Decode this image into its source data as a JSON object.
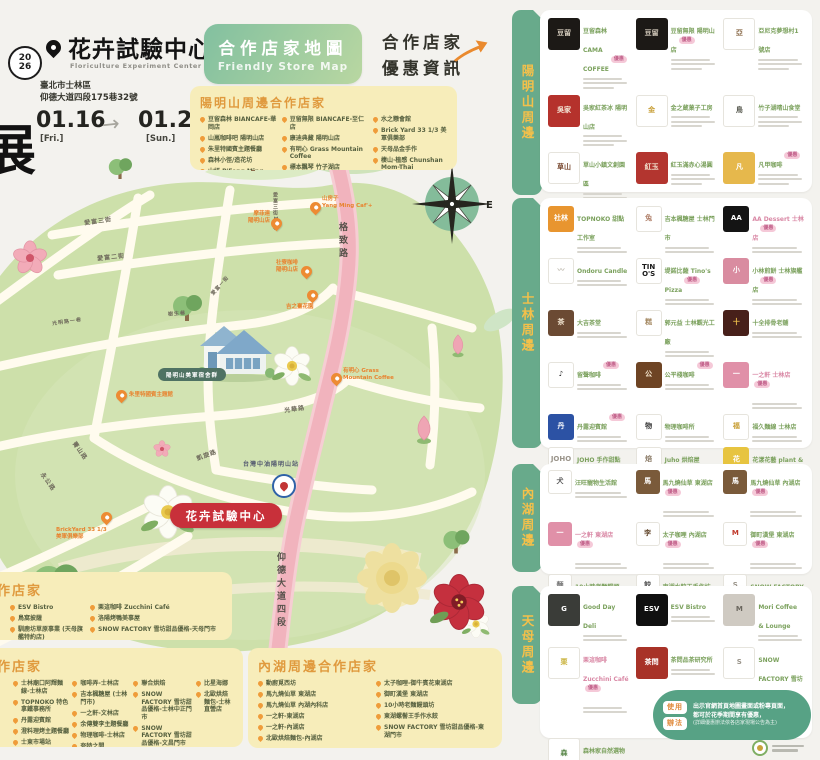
{
  "header": {
    "year_line1": "20",
    "year_line2": "26",
    "side_glyph": "展",
    "title": "花卉試驗中心",
    "subtitle": "Floriculture Experiment Center",
    "address_line1": "臺北市士林區",
    "address_line2": "仰德大道四段175巷32號",
    "date_start": "01.16",
    "date_start_day": "[Fri.]",
    "date_end": "01.25",
    "date_end_day": "[Sun.]",
    "arrow": "→"
  },
  "banner": {
    "title": "合作店家地圖",
    "subtitle": "Friendly Store Map"
  },
  "promo": {
    "line1": "合作店家",
    "line2": "優惠資訊"
  },
  "ym_box": {
    "title": "陽明山周邊合作店家",
    "cols": [
      [
        "豆留森林 BIANCAFE-華岡店",
        "山嵐咖啡吧 陽明山店",
        "朱里特國賓主題餐廳",
        "森林小徑/造花坊",
        "山妍 P'Feng Ming Caf'+"
      ],
      [
        "豆留無限 BIANCAFE-至仁店",
        "康迪典藏 陽明山店",
        "有明心 Grass Mountain Coffee",
        "標本飄琴 竹子湖店",
        "天溪梅仙人掌園"
      ],
      [
        "水之戀會館",
        "Brick Yard 33 1/3 美軍俱樂部",
        "天母品金手作",
        "棲山·植感 Chunshan Mom-Thai Glamping"
      ]
    ]
  },
  "map": {
    "compass_n": "N",
    "compass_e": "E",
    "center_badge": "花卉試驗中心",
    "house_label": "陽明山美軍宿舍群",
    "gas_label": "台灣中油陽明山站",
    "labels": {
      "aifu3": "愛富三街",
      "aifu2": "愛富二街",
      "aifu1": "愛富一街",
      "lane12": "愛富三街12巷",
      "gezhi": "格致路",
      "yangde": "仰德大道四段",
      "guanghua": "光華路",
      "kaixuan": "凱旋路",
      "jingshan": "菁山路",
      "yonggong": "永公路",
      "shusheng": "樹生巷",
      "zuoan": "光明路一巷"
    },
    "pins": [
      {
        "l1": "山房子",
        "l2": "Yang Ming Caf'+"
      },
      {
        "l1": "摩菲連",
        "l2": "陽明山店"
      },
      {
        "l1": "社寮咖啡",
        "l2": "陽明山店"
      },
      {
        "l1": "吉之臺花園",
        "l2": ""
      },
      {
        "l1": "有明心 Grass",
        "l2": "Mountain Coffee"
      },
      {
        "l1": "朱里特國賓主題館",
        "l2": ""
      },
      {
        "l1": "BrickYard 33 1/3",
        "l2": "美軍俱樂部"
      }
    ]
  },
  "bottom": {
    "tianmu": {
      "title": "天母周邊合作店家",
      "cols": [
        [
          "ESV Bistro",
          "鳥窩披薩",
          "馴鹿坊草原事業 (天母旗艦特約店)"
        ],
        [
          "栗這咖啡 Zucchini Café",
          "洛陽烤鴨美事屋",
          "SNOW FACTORY 雪坊甜品優格-天母門市"
        ]
      ]
    },
    "shilin": {
      "title": "士林周邊合作店家",
      "cols": [
        [
          "士林廟口阿輝麵線-士林店",
          "TOPNOKO 特色拿鐵事務所",
          "丹露迎賓館",
          "澄料理烤主題餐廳",
          "士東市場站",
          "記得擁抱純手工皂花店"
        ],
        [
          "咖啡弄-士林店",
          "吉本楓糖屋 (士林門市)",
          "一之軒-文林店",
          "余傳雙李主題餐廳",
          "物理咖啡-士林店",
          "夸特之間"
        ],
        [
          "聯合烘焙",
          "SNOW FACTORY 雪坊甜品優格-士林中正門市",
          "SNOW FACTORY 雪坊甜品優格-文昌門市",
          "Juho烘焙屋",
          "花漾花藝人/plant & studio"
        ],
        [
          "比星海娜",
          "北歐烘焙麵包-士林直營店"
        ]
      ]
    },
    "neihu": {
      "title": "內湖周邊合作店家",
      "cols": [
        [
          "動廚覓西坊",
          "馬九燒仙草 東湖店",
          "馬九燒仙草 內湖內科店",
          "一之軒-東湖店",
          "一之軒-內湖店",
          "北歐烘焙麵包-內湖店"
        ],
        [
          "太子咖哩-御牛賓花東湖店",
          "御町漢堡 東湖店",
          "10小時老麵饅頭坊",
          "東湖螺髻王手作水餃",
          "SNOW FACTORY 雪坊甜品優格-東湖門市"
        ]
      ]
    }
  },
  "right_panel": {
    "tabs": [
      "陽明山周邊",
      "士林周邊",
      "內湖周邊",
      "天母周邊"
    ],
    "sections": [
      [
        {
          "logo_bg": "#1c1916",
          "logo_fg": "#d8cfc0",
          "logo_text": "豆留",
          "name": "豆留森林 CAMA COFFEE",
          "badge": "優惠"
        },
        {
          "logo_bg": "#1c1916",
          "logo_fg": "#d8cfc0",
          "logo_text": "豆留",
          "name": "豆留無限 陽明山店",
          "badge": "優惠"
        },
        {
          "logo_bg": "#ffffff",
          "logo_fg": "#8a6b4a",
          "logo_text": "亞",
          "name": "亞尼克夢想村1號店"
        },
        {
          "logo_bg": "#b5322c",
          "logo_fg": "#f5e9d8",
          "logo_text": "吳家",
          "name": "吳家紅茶冰 陽明山店"
        },
        {
          "logo_bg": "#ffffff",
          "logo_fg": "#c9a13b",
          "logo_text": "金",
          "name": "金之蔵菓子工房"
        },
        {
          "logo_bg": "#ffffff",
          "logo_fg": "#56584e",
          "logo_text": "鳥",
          "name": "竹子湖晴山食堂"
        },
        {
          "logo_bg": "#ffffff",
          "logo_fg": "#7a4b32",
          "logo_text": "草山",
          "name": "草山小鎮文創園區"
        },
        {
          "logo_bg": "#b3352f",
          "logo_fg": "#f2e4d0",
          "logo_text": "紅玉",
          "name": "紅玉滿赤心湯圓"
        },
        {
          "logo_bg": "#e6b84c",
          "logo_fg": "#ffffff",
          "logo_text": "凡",
          "name": "凡甲咖啡",
          "badge": "優惠"
        },
        {
          "logo_bg": "#ffffff",
          "logo_fg": "#2e2b28",
          "logo_text": "白房子",
          "name": "白房子 Yang Ming Caf'+"
        },
        {
          "logo_bg": "#ffffff",
          "logo_fg": "#6b7d56",
          "logo_text": "植",
          "name": "棲山植感 Chunshan Mom-Thai Glamping"
        }
      ],
      [
        {
          "logo_bg": "#e8952f",
          "logo_fg": "#ffffff",
          "logo_text": "社林",
          "name": "TOPNOKO 甜點工作室"
        },
        {
          "logo_bg": "#ffffff",
          "logo_fg": "#b0806a",
          "logo_text": "兔",
          "name": "吉本楓糖屋 士林門市"
        },
        {
          "logo_bg": "#141414",
          "logo_fg": "#ffffff",
          "logo_text": "AA",
          "name": "AA Dessert 士林店",
          "badge": "優惠",
          "name_color": "#d988a5"
        },
        {
          "logo_bg": "#ffffff",
          "logo_fg": "#b9b4a8",
          "logo_text": "〰",
          "name": "Ondoru Candle"
        },
        {
          "logo_bg": "#ffffff",
          "logo_fg": "#191919",
          "logo_text": "TINO'S",
          "name": "堤諾比薩 Tino's Pizza",
          "badge": "優惠"
        },
        {
          "logo_bg": "#d98ca0",
          "logo_fg": "#ffffff",
          "logo_text": "小",
          "name": "小林煎餅 士林旗艦店",
          "badge": "優惠"
        },
        {
          "logo_bg": "#6b4a33",
          "logo_fg": "#f0e3cf",
          "logo_text": "茶",
          "name": "大吉茶堂"
        },
        {
          "logo_bg": "#ffffff",
          "logo_fg": "#a58a64",
          "logo_text": "糕",
          "name": "郭元益 士林觀光工廠"
        },
        {
          "logo_bg": "#47201a",
          "logo_fg": "#f2c24c",
          "logo_text": "十",
          "name": "十全排骨老舖"
        },
        {
          "logo_bg": "#ffffff",
          "logo_fg": "#222222",
          "logo_text": "♪",
          "name": "留聲咖啡",
          "badge": "優惠"
        },
        {
          "logo_bg": "#6e4424",
          "logo_fg": "#f5e7cf",
          "logo_text": "公",
          "name": "公平棧咖啡",
          "badge": "優惠"
        },
        {
          "logo_bg": "#e090a8",
          "logo_fg": "#ffffff",
          "logo_text": "一",
          "name": "一之軒 士林店",
          "badge": "優惠",
          "name_color": "#d988a5"
        },
        {
          "logo_bg": "#2c52a4",
          "logo_fg": "#ffffff",
          "logo_text": "丹",
          "name": "丹露迎賓館",
          "badge": "優惠"
        },
        {
          "logo_bg": "#ffffff",
          "logo_fg": "#333333",
          "logo_text": "物",
          "name": "物理咖啡所"
        },
        {
          "logo_bg": "#ffffff",
          "logo_fg": "#c9a13b",
          "logo_text": "福",
          "name": "福久麵線 士林店"
        },
        {
          "logo_bg": "#ffffff",
          "logo_fg": "#9a948a",
          "logo_text": "JOHO",
          "name": "JOHO 手作甜點"
        },
        {
          "logo_bg": "#ffffff",
          "logo_fg": "#8a7a66",
          "logo_text": "焙",
          "name": "Juho 烘焙屋"
        },
        {
          "logo_bg": "#e7c440",
          "logo_fg": "#ffffff",
          "logo_text": "花",
          "name": "花漾花藝 plant & studio",
          "badge": "優惠"
        },
        {
          "logo_bg": "#ffffff",
          "logo_fg": "#444444",
          "logo_text": "俺",
          "name": "大頭蝦鐵板燒",
          "badge": "優惠"
        },
        {
          "logo_bg": "#5f4632",
          "logo_fg": "#f0e0c8",
          "logo_text": "第六號",
          "name": "第六號倉庫",
          "badge": "優惠"
        },
        {
          "logo_bg": "#ffffff",
          "logo_fg": "#8a3b2e",
          "logo_text": "磚",
          "name": "紅磚布丁 士林門市",
          "badge": "優惠",
          "name_color": "#d988a5"
        }
      ],
      [
        {
          "logo_bg": "#ffffff",
          "logo_fg": "#555555",
          "logo_text": "犬",
          "name": "汪旺寵物生活館"
        },
        {
          "logo_bg": "#7a5a3a",
          "logo_fg": "#ffffff",
          "logo_text": "馬",
          "name": "馬九燒仙草 東湖店",
          "badge": "優惠"
        },
        {
          "logo_bg": "#7a5a3a",
          "logo_fg": "#ffffff",
          "logo_text": "馬",
          "name": "馬九燒仙草 內湖店",
          "badge": "優惠"
        },
        {
          "logo_bg": "#e090a8",
          "logo_fg": "#ffffff",
          "logo_text": "一",
          "name": "一之軒 東湖店",
          "badge": "優惠",
          "name_color": "#d988a5"
        },
        {
          "logo_bg": "#ffffff",
          "logo_fg": "#6b5138",
          "logo_text": "李",
          "name": "太子咖哩 內湖店",
          "badge": "優惠"
        },
        {
          "logo_bg": "#ffffff",
          "logo_fg": "#c0392b",
          "logo_text": "M",
          "name": "御町漢堡 東湖店",
          "badge": "優惠"
        },
        {
          "logo_bg": "#ffffff",
          "logo_fg": "#777777",
          "logo_text": "麵",
          "name": "10小時老麵饅頭"
        },
        {
          "logo_bg": "#ffffff",
          "logo_fg": "#555555",
          "logo_text": "餃",
          "name": "東湖水餃王手作坊"
        },
        {
          "logo_bg": "#ffffff",
          "logo_fg": "#9a948a",
          "logo_text": "S",
          "name": "SNOW FACTORY 雪坊優格 東湖門市",
          "badge": "優惠"
        }
      ],
      [
        {
          "logo_bg": "#3a3c38",
          "logo_fg": "#ffffff",
          "logo_text": "G",
          "name": "Good Day Deli"
        },
        {
          "logo_bg": "#101010",
          "logo_fg": "#ffffff",
          "logo_text": "ESV",
          "name": "ESV Bistro"
        },
        {
          "logo_bg": "#cfcac2",
          "logo_fg": "#6a665e",
          "logo_text": "M",
          "name": "Mori Coffee & Lounge"
        },
        {
          "logo_bg": "#ffffff",
          "logo_fg": "#c9b23c",
          "logo_text": "栗",
          "name": "栗這咖啡 Zucchini Café",
          "badge": "優惠",
          "name_color": "#d988a5"
        },
        {
          "logo_bg": "#a83228",
          "logo_fg": "#ffffff",
          "logo_text": "茶問",
          "name": "茶問品茶研究所"
        },
        {
          "logo_bg": "#ffffff",
          "logo_fg": "#9a948a",
          "logo_text": "S",
          "name": "SNOW FACTORY 雪坊優格 天母門市",
          "badge": "優惠"
        },
        {
          "logo_bg": "#ffffff",
          "logo_fg": "#5d8a4e",
          "logo_text": "森",
          "name": "森林家自然選物"
        }
      ]
    ]
  },
  "usage": {
    "badge1": "使用",
    "badge2": "辦法",
    "line1": "出示官網首頁地圖畫面或粉專頁面，",
    "line2": "都可於花季期間享有優惠，",
    "line3": "(詳細優惠辦法依各店家現場公告為主)"
  },
  "colors": {
    "accent_orange": "#ea8a2e",
    "tab_green": "#68aa8b",
    "road_pink": "#f1b3bd",
    "badge_pink": "#f5c9d8",
    "box_yellow": "#f7edba",
    "center_red": "#c8303a"
  }
}
